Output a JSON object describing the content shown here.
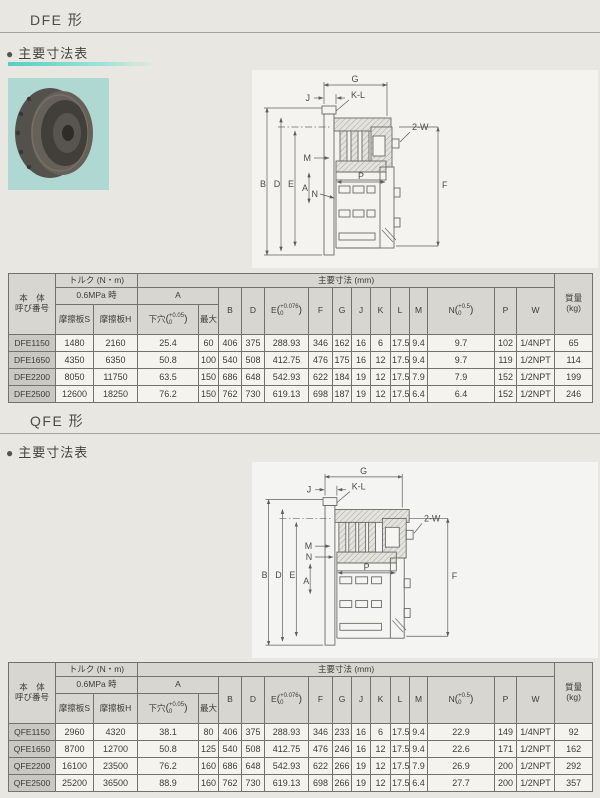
{
  "colors": {
    "page_bg": "#E9E7E1",
    "accent_teal": "#57CEC0",
    "photo_bg": "#AED8D1",
    "header_bg": "#D7D6D1",
    "model_col_bg": "#C9C8C2"
  },
  "dfe_section": {
    "title": "DFE 形",
    "bullet": "●",
    "heading": "主要寸法表"
  },
  "qfe_section": {
    "title": "QFE 形",
    "bullet": "●",
    "heading": "主要寸法表"
  },
  "table_header": {
    "body_line1": "本　体",
    "body_line2": "呼び番号",
    "torque_group": "トルク (N・m)",
    "pressure_row": "0.6MPa 時",
    "friction_s": "摩擦板S",
    "friction_h": "摩擦板H",
    "main_dims_group": "主要寸法 (mm)",
    "a_group": "A",
    "pilot_hole": "下穴",
    "pilot_tol_top": "+0.05",
    "pilot_tol_bot": "0",
    "max": "最大",
    "b": "B",
    "d": "D",
    "e": "E",
    "e_tol_top": "+0.076",
    "e_tol_bot": "0",
    "f": "F",
    "g": "G",
    "j": "J",
    "k": "K",
    "l": "L",
    "m": "M",
    "n": "N",
    "n_tol_top": "+0.5",
    "n_tol_bot": "0",
    "p": "P",
    "w": "W",
    "mass_line1": "質量",
    "mass_line2": "(kg)"
  },
  "dfe_table": {
    "rows": [
      {
        "name": "DFE1150",
        "s": "1480",
        "h": "2160",
        "pilot": "25.4",
        "max": "60",
        "b": "406",
        "d": "375",
        "e": "288.93",
        "f": "346",
        "g": "162",
        "j": "16",
        "k": "6",
        "l": "17.5",
        "m": "9.4",
        "n": "9.7",
        "p": "102",
        "w": "1/4NPT",
        "mass": "65"
      },
      {
        "name": "DFE1650",
        "s": "4350",
        "h": "6350",
        "pilot": "50.8",
        "max": "100",
        "b": "540",
        "d": "508",
        "e": "412.75",
        "f": "476",
        "g": "175",
        "j": "16",
        "k": "12",
        "l": "17.5",
        "m": "9.4",
        "n": "9.7",
        "p": "119",
        "w": "1/2NPT",
        "mass": "114"
      },
      {
        "name": "DFE2200",
        "s": "8050",
        "h": "11750",
        "pilot": "63.5",
        "max": "150",
        "b": "686",
        "d": "648",
        "e": "542.93",
        "f": "622",
        "g": "184",
        "j": "19",
        "k": "12",
        "l": "17.5",
        "m": "7.9",
        "n": "7.9",
        "p": "152",
        "w": "1/2NPT",
        "mass": "199"
      },
      {
        "name": "DFE2500",
        "s": "12600",
        "h": "18250",
        "pilot": "76.2",
        "max": "150",
        "b": "762",
        "d": "730",
        "e": "619.13",
        "f": "698",
        "g": "187",
        "j": "19",
        "k": "12",
        "l": "17.5",
        "m": "6.4",
        "n": "6.4",
        "p": "152",
        "w": "1/2NPT",
        "mass": "246"
      }
    ]
  },
  "qfe_table": {
    "rows": [
      {
        "name": "QFE1150",
        "s": "2960",
        "h": "4320",
        "pilot": "38.1",
        "max": "80",
        "b": "406",
        "d": "375",
        "e": "288.93",
        "f": "346",
        "g": "233",
        "j": "16",
        "k": "6",
        "l": "17.5",
        "m": "9.4",
        "n": "22.9",
        "p": "149",
        "w": "1/4NPT",
        "mass": "92"
      },
      {
        "name": "QFE1650",
        "s": "8700",
        "h": "12700",
        "pilot": "50.8",
        "max": "125",
        "b": "540",
        "d": "508",
        "e": "412.75",
        "f": "476",
        "g": "246",
        "j": "16",
        "k": "12",
        "l": "17.5",
        "m": "9.4",
        "n": "22.6",
        "p": "171",
        "w": "1/2NPT",
        "mass": "162"
      },
      {
        "name": "QFE2200",
        "s": "16100",
        "h": "23500",
        "pilot": "76.2",
        "max": "160",
        "b": "686",
        "d": "648",
        "e": "542.93",
        "f": "622",
        "g": "266",
        "j": "19",
        "k": "12",
        "l": "17.5",
        "m": "7.9",
        "n": "26.9",
        "p": "200",
        "w": "1/2NPT",
        "mass": "292"
      },
      {
        "name": "QFE2500",
        "s": "25200",
        "h": "36500",
        "pilot": "88.9",
        "max": "160",
        "b": "762",
        "d": "730",
        "e": "619.13",
        "f": "698",
        "g": "266",
        "j": "19",
        "k": "12",
        "l": "17.5",
        "m": "6.4",
        "n": "27.7",
        "p": "200",
        "w": "1/2NPT",
        "mass": "357"
      }
    ]
  },
  "drawing_labels": {
    "g": "G",
    "j": "J",
    "kl": "K-L",
    "two_w": "2-W",
    "m": "M",
    "n": "N",
    "b": "B",
    "d": "D",
    "e": "E",
    "a": "A",
    "p": "P",
    "f": "F"
  }
}
